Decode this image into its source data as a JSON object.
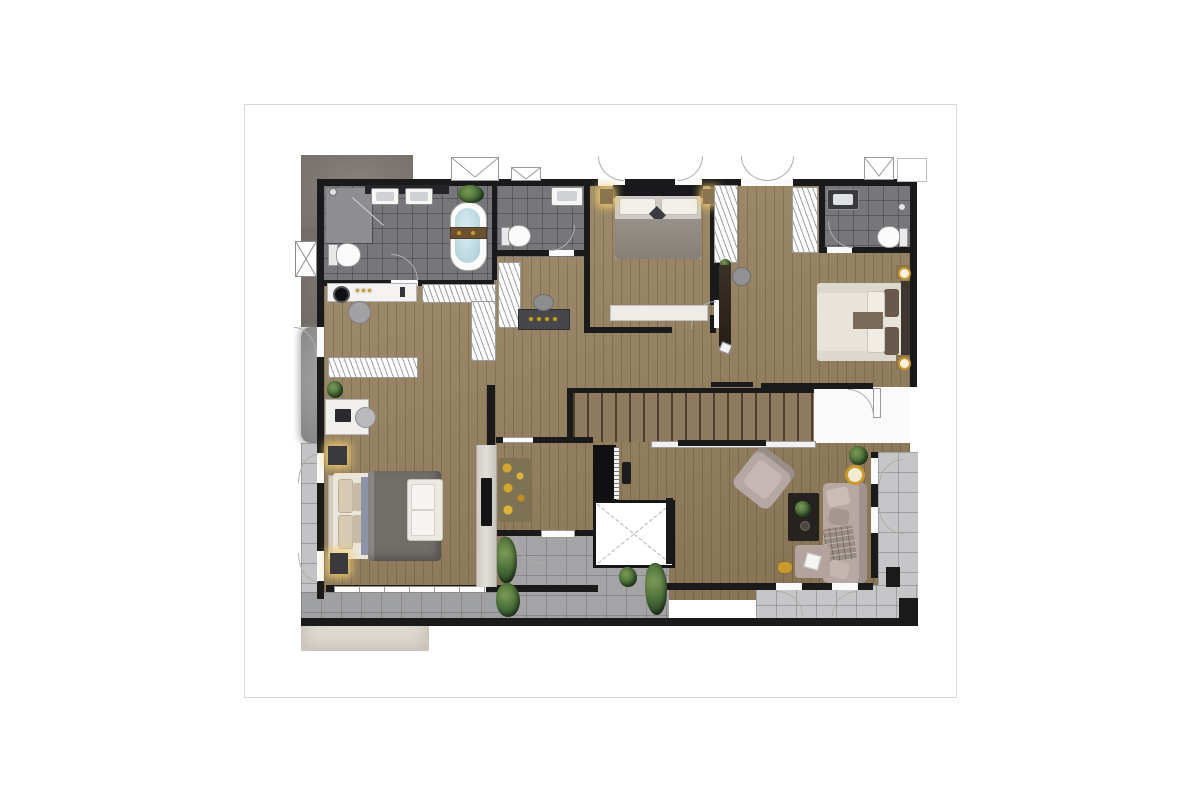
{
  "document": {
    "kind": "residential floor plan rendering",
    "page_background": "#ffffff",
    "page_border": "#d6d6d6"
  },
  "palette": {
    "wall": "#1a1a1a",
    "wood_floor": "#97825f",
    "bath_tile": "#77777b",
    "balcony_tile": "#a8a8aa",
    "rug_gray": "#807b76",
    "rug_cream": "#e2ddd3",
    "rug_fluffy_gray": "#9c9c9c",
    "bed_cream": "#e9e4d9",
    "duvet_gray": "#6f6b68",
    "sofa_mauve": "#b5a7a2",
    "gold_accent": "#c9992e",
    "plant_green": "#466b36",
    "tub_water": "#bcd8e0",
    "fixture_white": "#f6f6f4"
  },
  "rooms": [
    {
      "name": "master bathroom"
    },
    {
      "name": "bathroom 2"
    },
    {
      "name": "bathroom 3"
    },
    {
      "name": "bedroom 1"
    },
    {
      "name": "walk-in closet"
    },
    {
      "name": "bedroom 2"
    },
    {
      "name": "dressing area / hallway"
    },
    {
      "name": "master bedroom"
    },
    {
      "name": "sitting room"
    },
    {
      "name": "living room"
    },
    {
      "name": "staircase"
    },
    {
      "name": "elevator"
    },
    {
      "name": "center terrace"
    },
    {
      "name": "left balcony"
    },
    {
      "name": "bottom balcony"
    },
    {
      "name": "right balcony"
    }
  ],
  "fixtures": [
    "double-sink vanity",
    "freestanding bathtub",
    "toilet x3",
    "shower enclosure",
    "bed x3",
    "nightstand lamps",
    "wardrobe racks",
    "vanity desk with mirror",
    "writing desk",
    "tv media wall",
    "gold cushion sofa",
    "upright piano",
    "sectional sofa",
    "armchair",
    "coffee table",
    "ottoman",
    "area rugs",
    "potted plants",
    "stair treads",
    "elevator shaft",
    "window symbols",
    "door swing arcs"
  ]
}
